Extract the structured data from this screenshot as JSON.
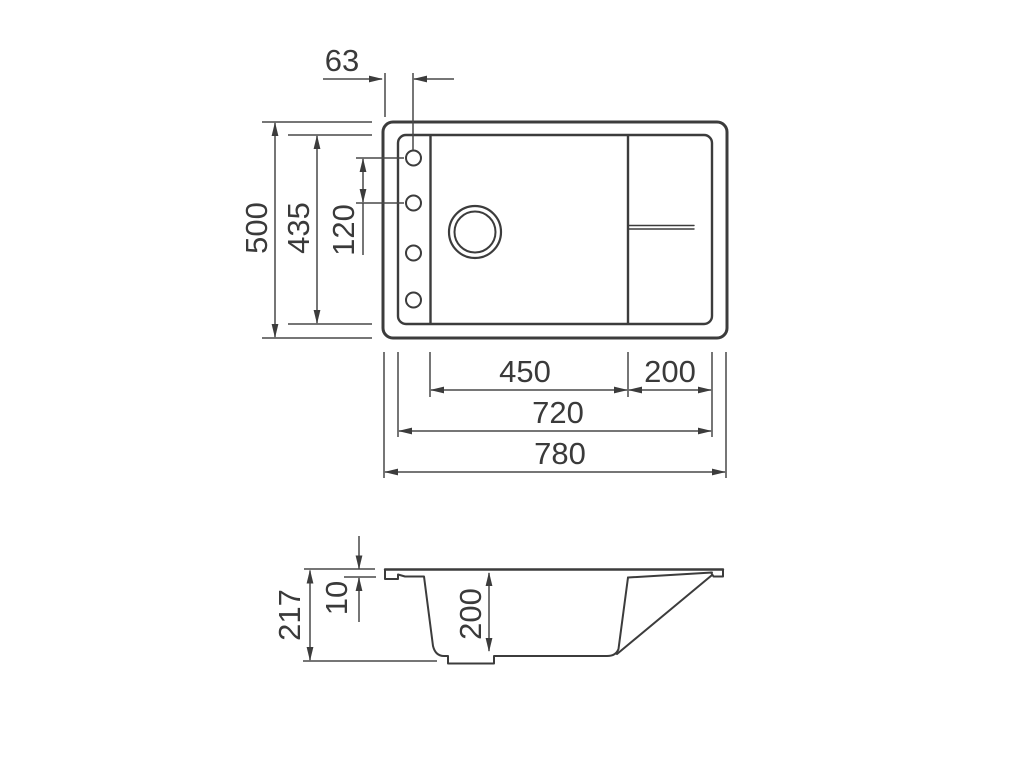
{
  "drawing": {
    "title": "sink-dimension-drawing",
    "background_color": "#ffffff",
    "line_color": "#3c3c3c",
    "dim_line_color": "#484848",
    "text_color": "#3a3a3a",
    "top_view": {
      "dims": {
        "hole_offset": "63",
        "outer_depth": "500",
        "inner_depth": "435",
        "hole_spacing": "120",
        "bowl_width": "450",
        "drainboard_width": "200",
        "inner_width": "720",
        "outer_width": "780"
      },
      "features": {
        "faucet_hole_count": 4,
        "drain_hole": 1
      }
    },
    "section_view": {
      "dims": {
        "total_height": "217",
        "rim_thickness": "10",
        "bowl_depth": "200"
      }
    }
  }
}
